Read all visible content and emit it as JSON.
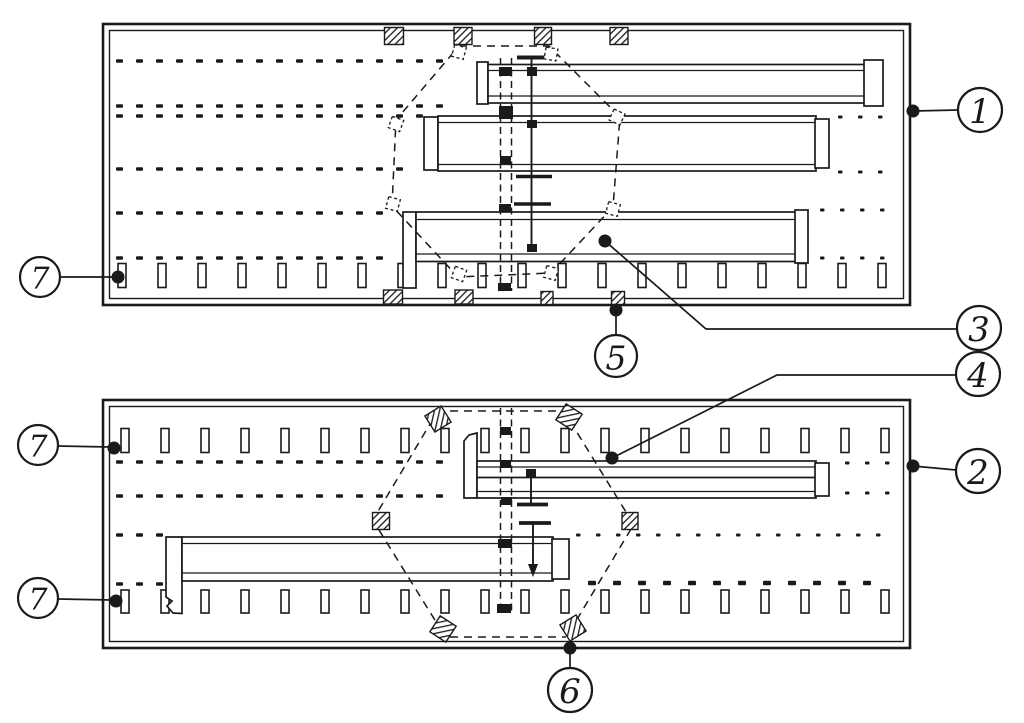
{
  "figure": {
    "title": "Technical line drawing: two rectangular plan views with numbered part callouts",
    "ink_color": "#1a1a1a",
    "paper_color": "#ffffff",
    "callouts": [
      {
        "name": "callout-1",
        "label": "1"
      },
      {
        "name": "callout-2",
        "label": "2"
      },
      {
        "name": "callout-3",
        "label": "3"
      },
      {
        "name": "callout-4",
        "label": "4"
      },
      {
        "name": "callout-5",
        "label": "5"
      },
      {
        "name": "callout-6",
        "label": "6"
      },
      {
        "name": "callout-7-upper",
        "label": "7"
      },
      {
        "name": "callout-7-middle",
        "label": "7"
      },
      {
        "name": "callout-7-lower",
        "label": "7"
      }
    ]
  }
}
